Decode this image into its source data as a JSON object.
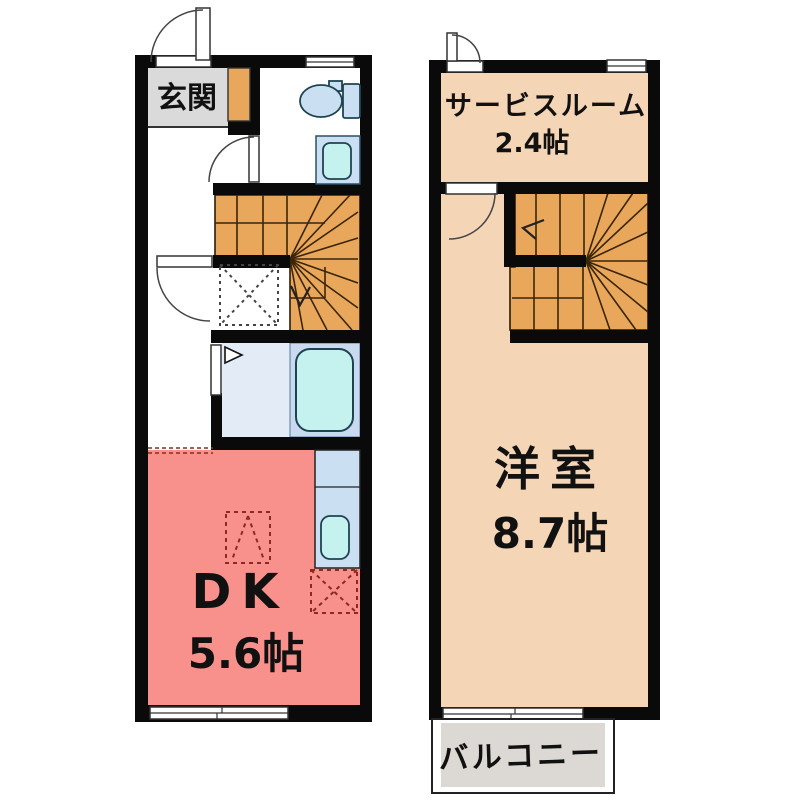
{
  "floor1": {
    "entrance_label": "玄関",
    "dining_kitchen": {
      "label": "DK",
      "size": "5.6帖"
    }
  },
  "floor2": {
    "service_room": {
      "label": "サービスルーム",
      "size": "2.4帖"
    },
    "western_room": {
      "label": "洋室",
      "size": "8.7帖"
    },
    "balcony_label": "バルコニー"
  },
  "colors": {
    "wall": "#0a0a0a",
    "dk_pink": "#F8908B",
    "room_tan": "#F4D5B5",
    "stairs_orange": "#E9A75B",
    "entrance_gray": "#DADADA",
    "balcony_gray": "#DCD8D3",
    "fixture_blue": "#CADFF2",
    "bath_floor_blue": "#E2EBF6",
    "tub_panel_blue": "#C9D9EF",
    "water_cyan": "#C5F1EF",
    "marker_red": "#8A2A22"
  }
}
